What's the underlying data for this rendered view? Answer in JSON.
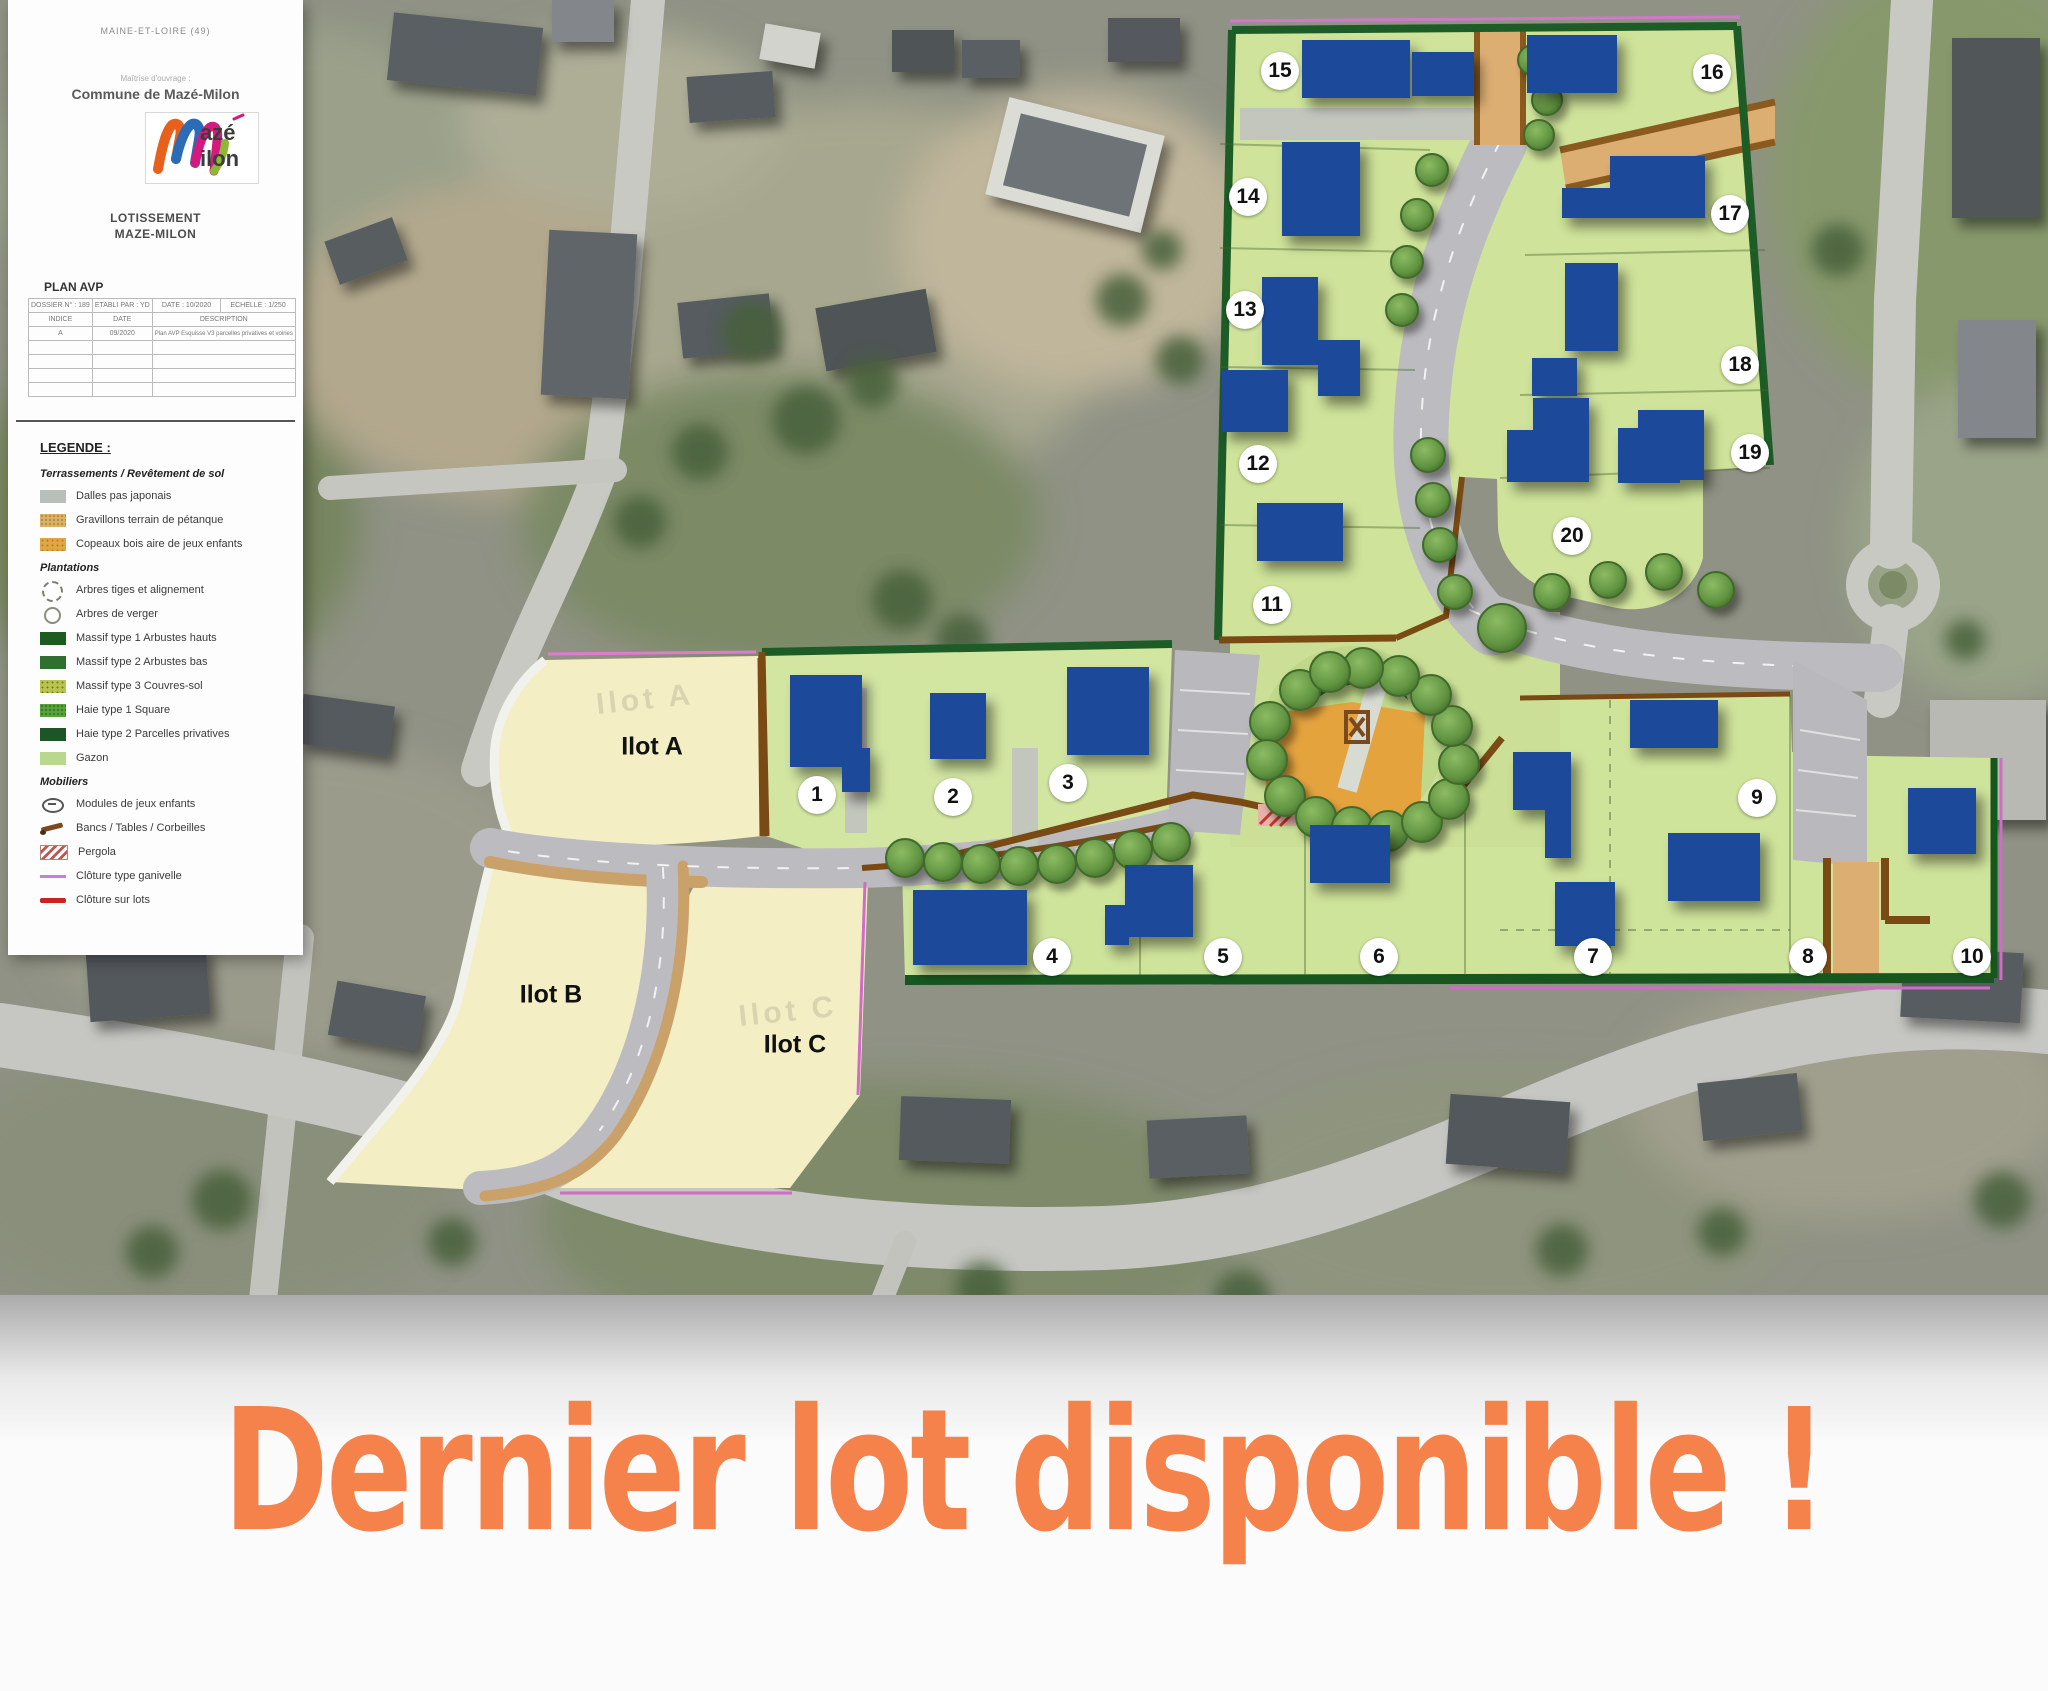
{
  "panel": {
    "department": "MAINE-ET-LOIRE (49)",
    "client_label": "Maîtrise d'ouvrage :",
    "client": "Commune de Mazé-Milon",
    "logo_word_top": "azé",
    "logo_word_bottom": "ilon",
    "project_title_line1": "LOTISSEMENT",
    "project_title_line2": "MAZE-MILON",
    "plan_type": "PLAN AVP",
    "info_table": {
      "header_cells": [
        "DOSSIER N° : 189",
        "ETABLI PAR : YD",
        "DATE : 10/2020",
        "ECHELLE : 1/250"
      ],
      "subheader_cells": [
        "INDICE",
        "DATE",
        "DESCRIPTION"
      ],
      "rows": [
        [
          "A",
          "09/2020",
          "Plan AVP Esquisse V3 parcelles privatives et voiries"
        ],
        [
          "",
          "",
          ""
        ],
        [
          "",
          "",
          ""
        ],
        [
          "",
          "",
          ""
        ],
        [
          "",
          "",
          ""
        ]
      ]
    },
    "legend": {
      "title": "LEGENDE :",
      "groups": [
        {
          "heading": "Terrassements / Revêtement de sol",
          "items": [
            {
              "swatch": "dalles",
              "label": "Dalles pas japonais"
            },
            {
              "swatch": "gravillons",
              "label": "Gravillons terrain de pétanque"
            },
            {
              "swatch": "copeaux",
              "label": "Copeaux bois aire de jeux enfants"
            }
          ]
        },
        {
          "heading": "Plantations",
          "items": [
            {
              "swatch": "arbre-tige",
              "label": "Arbres tiges et alignement"
            },
            {
              "swatch": "arbre-verger",
              "label": "Arbres de verger"
            },
            {
              "swatch": "massif1",
              "label": "Massif type 1 Arbustes hauts"
            },
            {
              "swatch": "massif2",
              "label": "Massif type 2 Arbustes bas"
            },
            {
              "swatch": "massif3",
              "label": "Massif type 3 Couvres-sol"
            },
            {
              "swatch": "haie1",
              "label": "Haie type 1 Square"
            },
            {
              "swatch": "haie2",
              "label": "Haie type 2 Parcelles privatives"
            },
            {
              "swatch": "gazon",
              "label": "Gazon"
            }
          ]
        },
        {
          "heading": "Mobiliers",
          "items": [
            {
              "swatch": "jeux",
              "label": "Modules de jeux enfants"
            },
            {
              "swatch": "banc",
              "label": "Bancs / Tables / Corbeilles"
            },
            {
              "swatch": "pergola",
              "label": "Pergola"
            },
            {
              "swatch": "ganivelle",
              "label": "Clôture type ganivelle"
            },
            {
              "swatch": "cloture",
              "label": "Clôture sur lots"
            }
          ]
        }
      ]
    }
  },
  "plan": {
    "lots": [
      {
        "number": "1",
        "x": 817,
        "y": 795
      },
      {
        "number": "2",
        "x": 953,
        "y": 797
      },
      {
        "number": "3",
        "x": 1068,
        "y": 783
      },
      {
        "number": "4",
        "x": 1052,
        "y": 957
      },
      {
        "number": "5",
        "x": 1223,
        "y": 957
      },
      {
        "number": "6",
        "x": 1379,
        "y": 957
      },
      {
        "number": "7",
        "x": 1593,
        "y": 957
      },
      {
        "number": "8",
        "x": 1808,
        "y": 957
      },
      {
        "number": "9",
        "x": 1757,
        "y": 798
      },
      {
        "number": "10",
        "x": 1972,
        "y": 957
      },
      {
        "number": "11",
        "x": 1272,
        "y": 605
      },
      {
        "number": "12",
        "x": 1258,
        "y": 464
      },
      {
        "number": "13",
        "x": 1245,
        "y": 310
      },
      {
        "number": "14",
        "x": 1248,
        "y": 197
      },
      {
        "number": "15",
        "x": 1280,
        "y": 71
      },
      {
        "number": "16",
        "x": 1712,
        "y": 73
      },
      {
        "number": "17",
        "x": 1730,
        "y": 214
      },
      {
        "number": "18",
        "x": 1740,
        "y": 365
      },
      {
        "number": "19",
        "x": 1750,
        "y": 453
      },
      {
        "number": "20",
        "x": 1572,
        "y": 536
      }
    ],
    "ilots": [
      {
        "label": "Ilot A",
        "x": 652,
        "y": 747
      },
      {
        "label": "Ilot B",
        "x": 551,
        "y": 995
      },
      {
        "label": "Ilot C",
        "x": 795,
        "y": 1045
      }
    ],
    "watermarks": [
      {
        "label": "Ilot A",
        "x": 645,
        "y": 700
      },
      {
        "label": "Ilot C",
        "x": 788,
        "y": 1012
      }
    ]
  },
  "banner": {
    "text": "Dernier lot disponible !",
    "color": "#f5814b"
  }
}
